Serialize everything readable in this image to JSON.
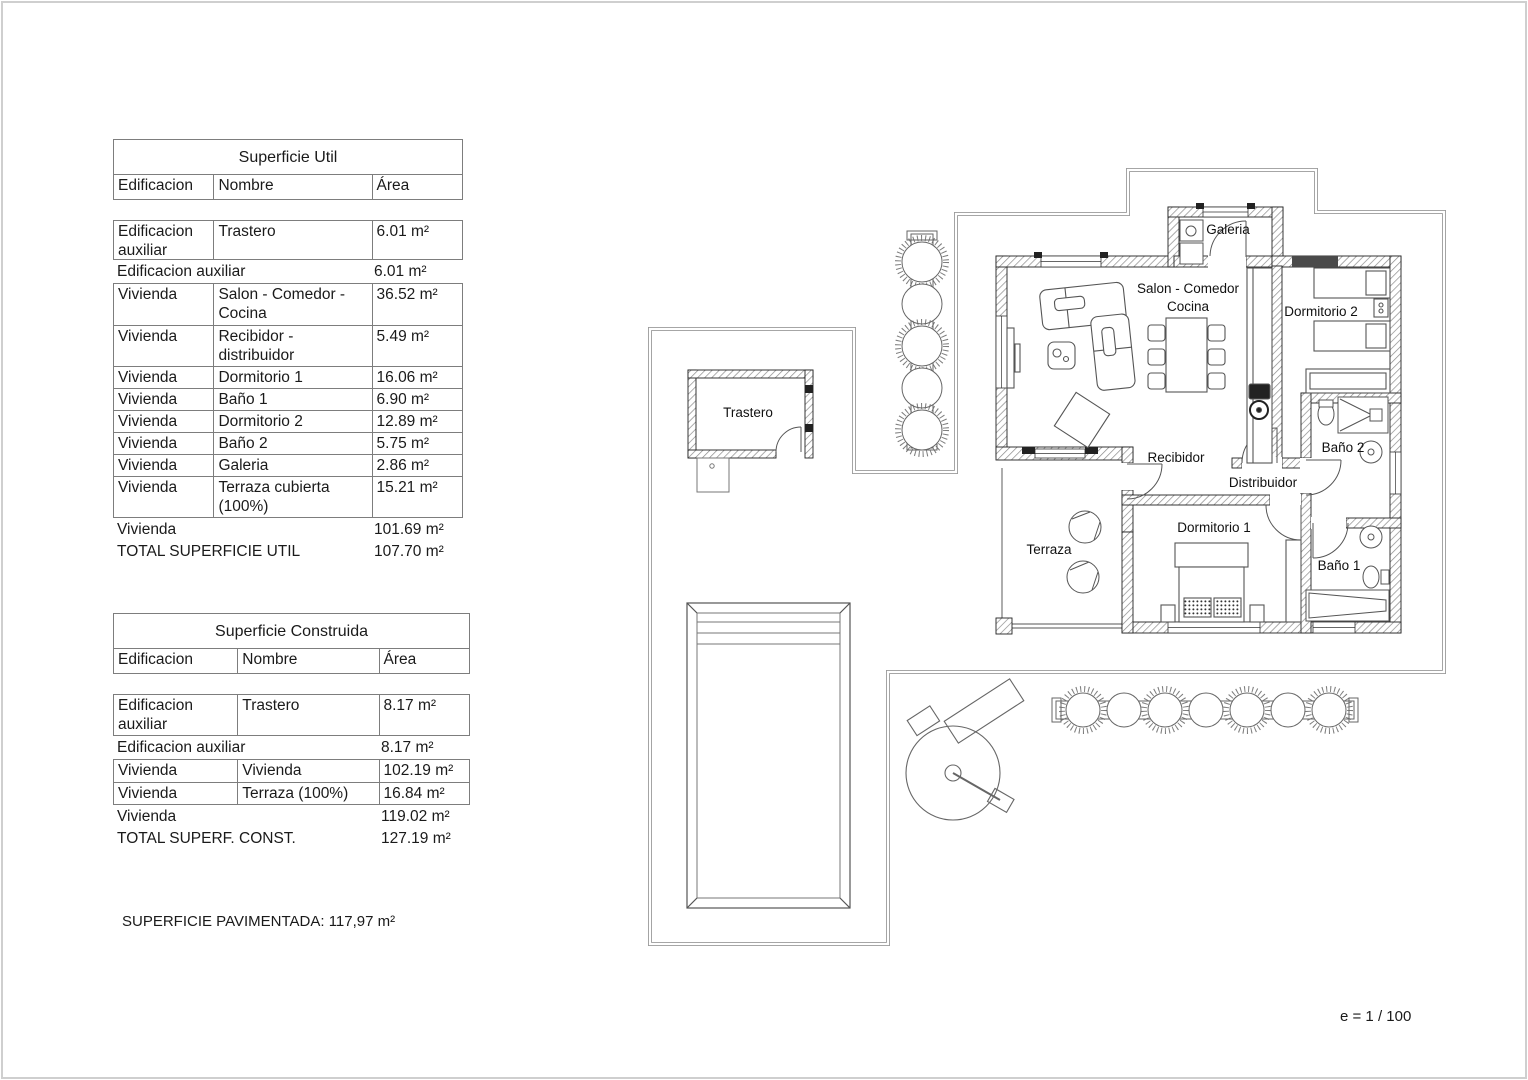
{
  "notes": {
    "paved": "SUPERFICIE PAVIMENTADA: 117,97 m²",
    "scale": "e = 1 / 100"
  },
  "tables": {
    "util": {
      "title": "Superficie Util",
      "col_edificacion": "Edificacion",
      "col_nombre": "Nombre",
      "col_area": "Área",
      "aux": {
        "edificacion": "Edificacion auxiliar",
        "nombre": "Trastero",
        "area": "6.01 m²"
      },
      "aux_total": {
        "label": "Edificacion auxiliar",
        "area": "6.01 m²"
      },
      "rows": [
        {
          "e": "Vivienda",
          "n": "Salon - Comedor - Cocina",
          "a": "36.52 m²"
        },
        {
          "e": "Vivienda",
          "n": "Recibidor - distribuidor",
          "a": "5.49 m²"
        },
        {
          "e": "Vivienda",
          "n": "Dormitorio 1",
          "a": "16.06 m²"
        },
        {
          "e": "Vivienda",
          "n": "Baño 1",
          "a": "6.90 m²"
        },
        {
          "e": "Vivienda",
          "n": "Dormitorio 2",
          "a": "12.89 m²"
        },
        {
          "e": "Vivienda",
          "n": "Baño 2",
          "a": "5.75 m²"
        },
        {
          "e": "Vivienda",
          "n": "Galeria",
          "a": "2.86 m²"
        },
        {
          "e": "Vivienda",
          "n": "Terraza cubierta (100%)",
          "a": "15.21 m²"
        }
      ],
      "vivienda_total": {
        "label": "Vivienda",
        "area": "101.69 m²"
      },
      "total": {
        "label": "TOTAL SUPERFICIE UTIL",
        "area": "107.70 m²"
      }
    },
    "construida": {
      "title": "Superficie Construida",
      "col_edificacion": "Edificacion",
      "col_nombre": "Nombre",
      "col_area": "Área",
      "aux": {
        "edificacion": "Edificacion auxiliar",
        "nombre": "Trastero",
        "area": "8.17 m²"
      },
      "aux_total": {
        "label": "Edificacion auxiliar",
        "area": "8.17 m²"
      },
      "rows": [
        {
          "e": "Vivienda",
          "n": "Vivienda",
          "a": "102.19 m²"
        },
        {
          "e": "Vivienda",
          "n": "Terraza (100%)",
          "a": "16.84 m²"
        }
      ],
      "vivienda_total": {
        "label": "Vivienda",
        "area": "119.02 m²"
      },
      "total": {
        "label": "TOTAL SUPERF. CONST.",
        "area": "127.19 m²"
      }
    }
  },
  "floorplan": {
    "rooms": {
      "galeria": "Galeria",
      "salon_line1": "Salon - Comedor",
      "salon_line2": "Cocina",
      "dormitorio2": "Dormitorio 2",
      "bano2": "Baño 2",
      "recibidor": "Recibidor",
      "distribuidor": "Distribuidor",
      "terraza": "Terraza",
      "dormitorio1": "Dormitorio 1",
      "bano1": "Baño 1",
      "trastero": "Trastero"
    }
  }
}
